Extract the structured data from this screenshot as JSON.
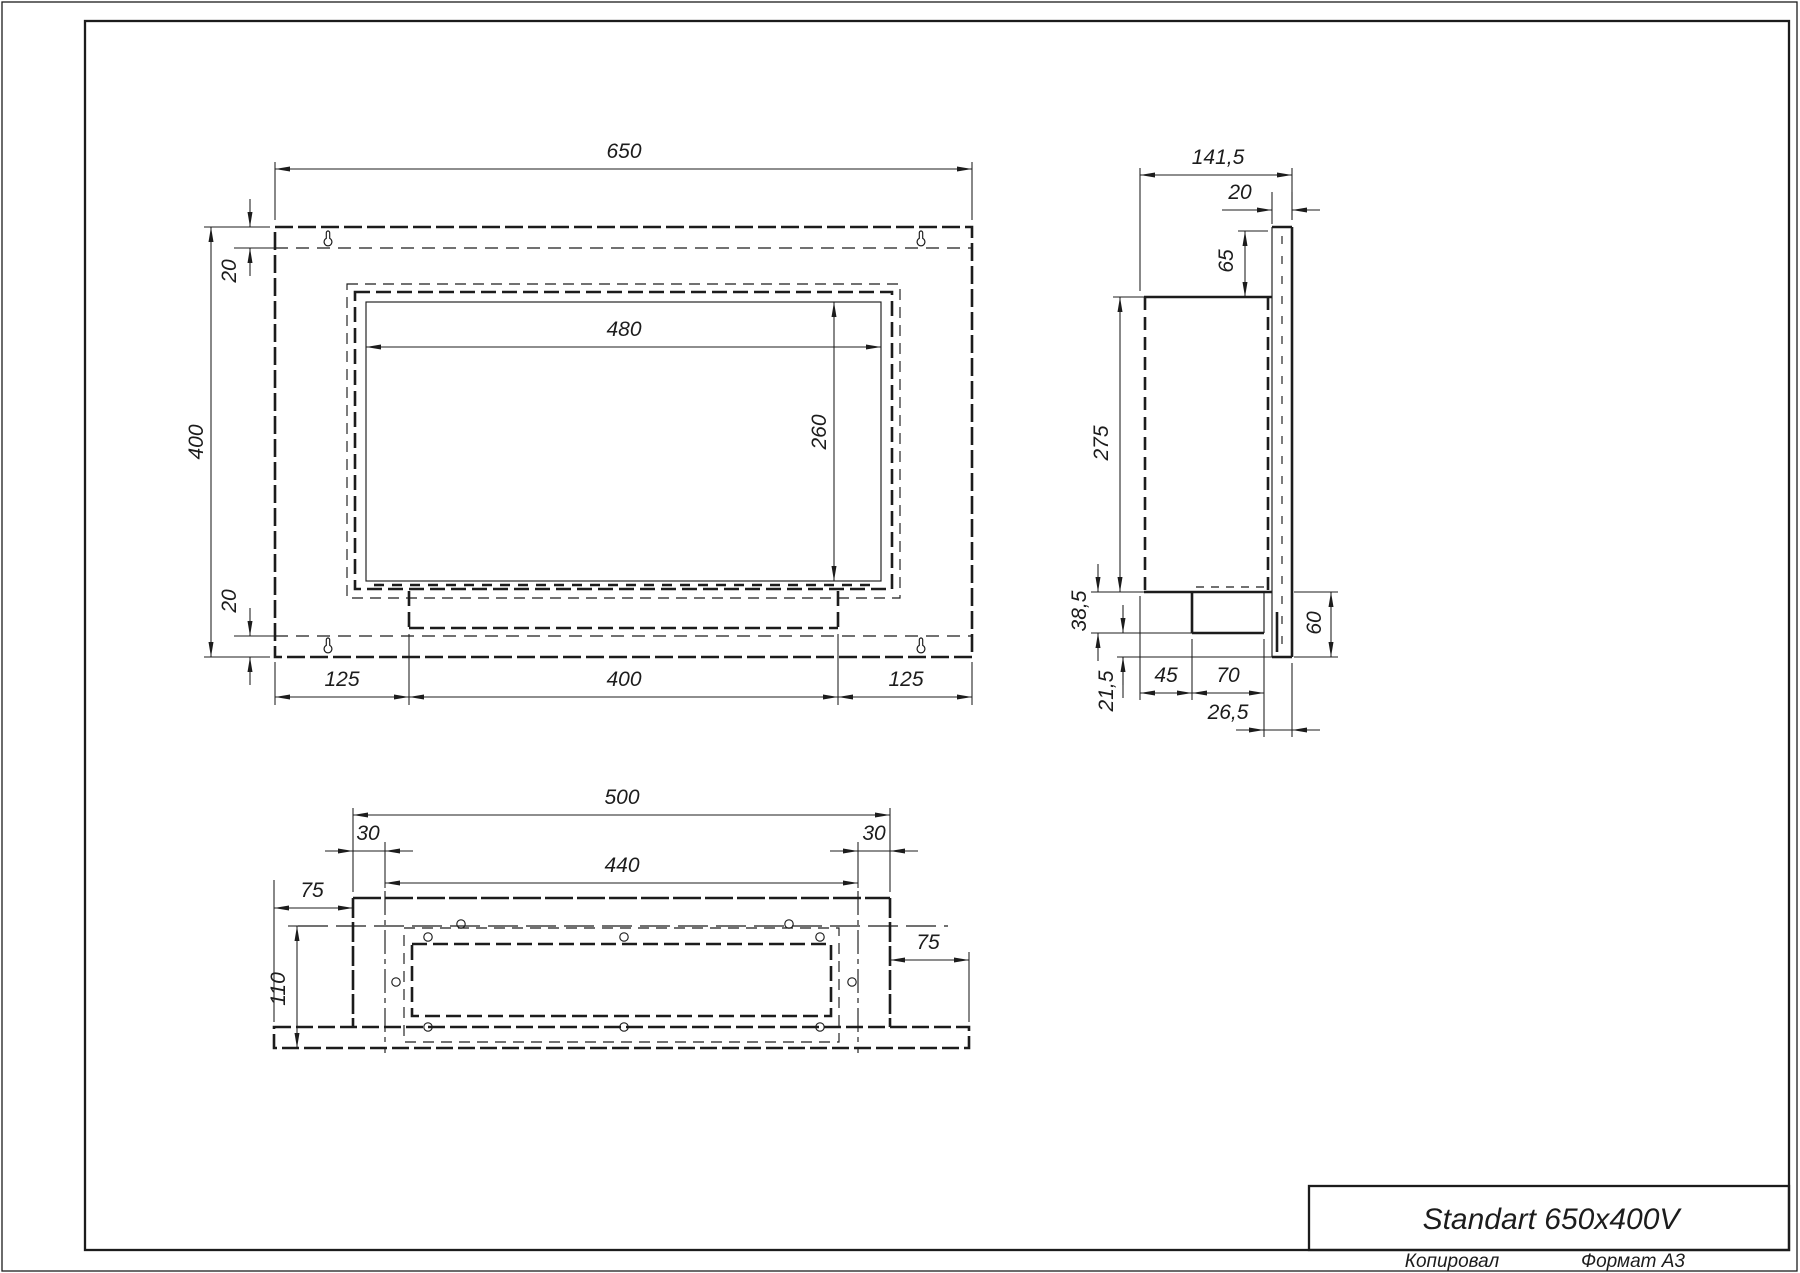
{
  "page": {
    "background": "#ffffff",
    "line_color": "#1c1c1c"
  },
  "title_block": {
    "title": "Standart 650x400V"
  },
  "footer": {
    "copied_label": "Копировал",
    "format_label": "Формат А3"
  },
  "front_view": {
    "dims": {
      "width": "650",
      "height": "400",
      "top_margin": "20",
      "bottom_margin": "20",
      "opening_width": "480",
      "opening_height": "260",
      "foot_left": "125",
      "foot_center": "400",
      "foot_right": "125"
    }
  },
  "side_view": {
    "dims": {
      "depth": "141,5",
      "flange_offset": "20",
      "top_offset": "65",
      "body_height": "275",
      "tray_drop": "38,5",
      "tray_clearance": "21,5",
      "tray_setback": "45",
      "tray_width": "70",
      "front_setback": "26,5",
      "bottom_offset": "60"
    }
  },
  "bottom_view": {
    "dims": {
      "body_width": "500",
      "inset_left": "30",
      "inset_right": "30",
      "inner_width": "440",
      "flange_left": "75",
      "flange_right": "75",
      "body_depth": "110"
    }
  }
}
